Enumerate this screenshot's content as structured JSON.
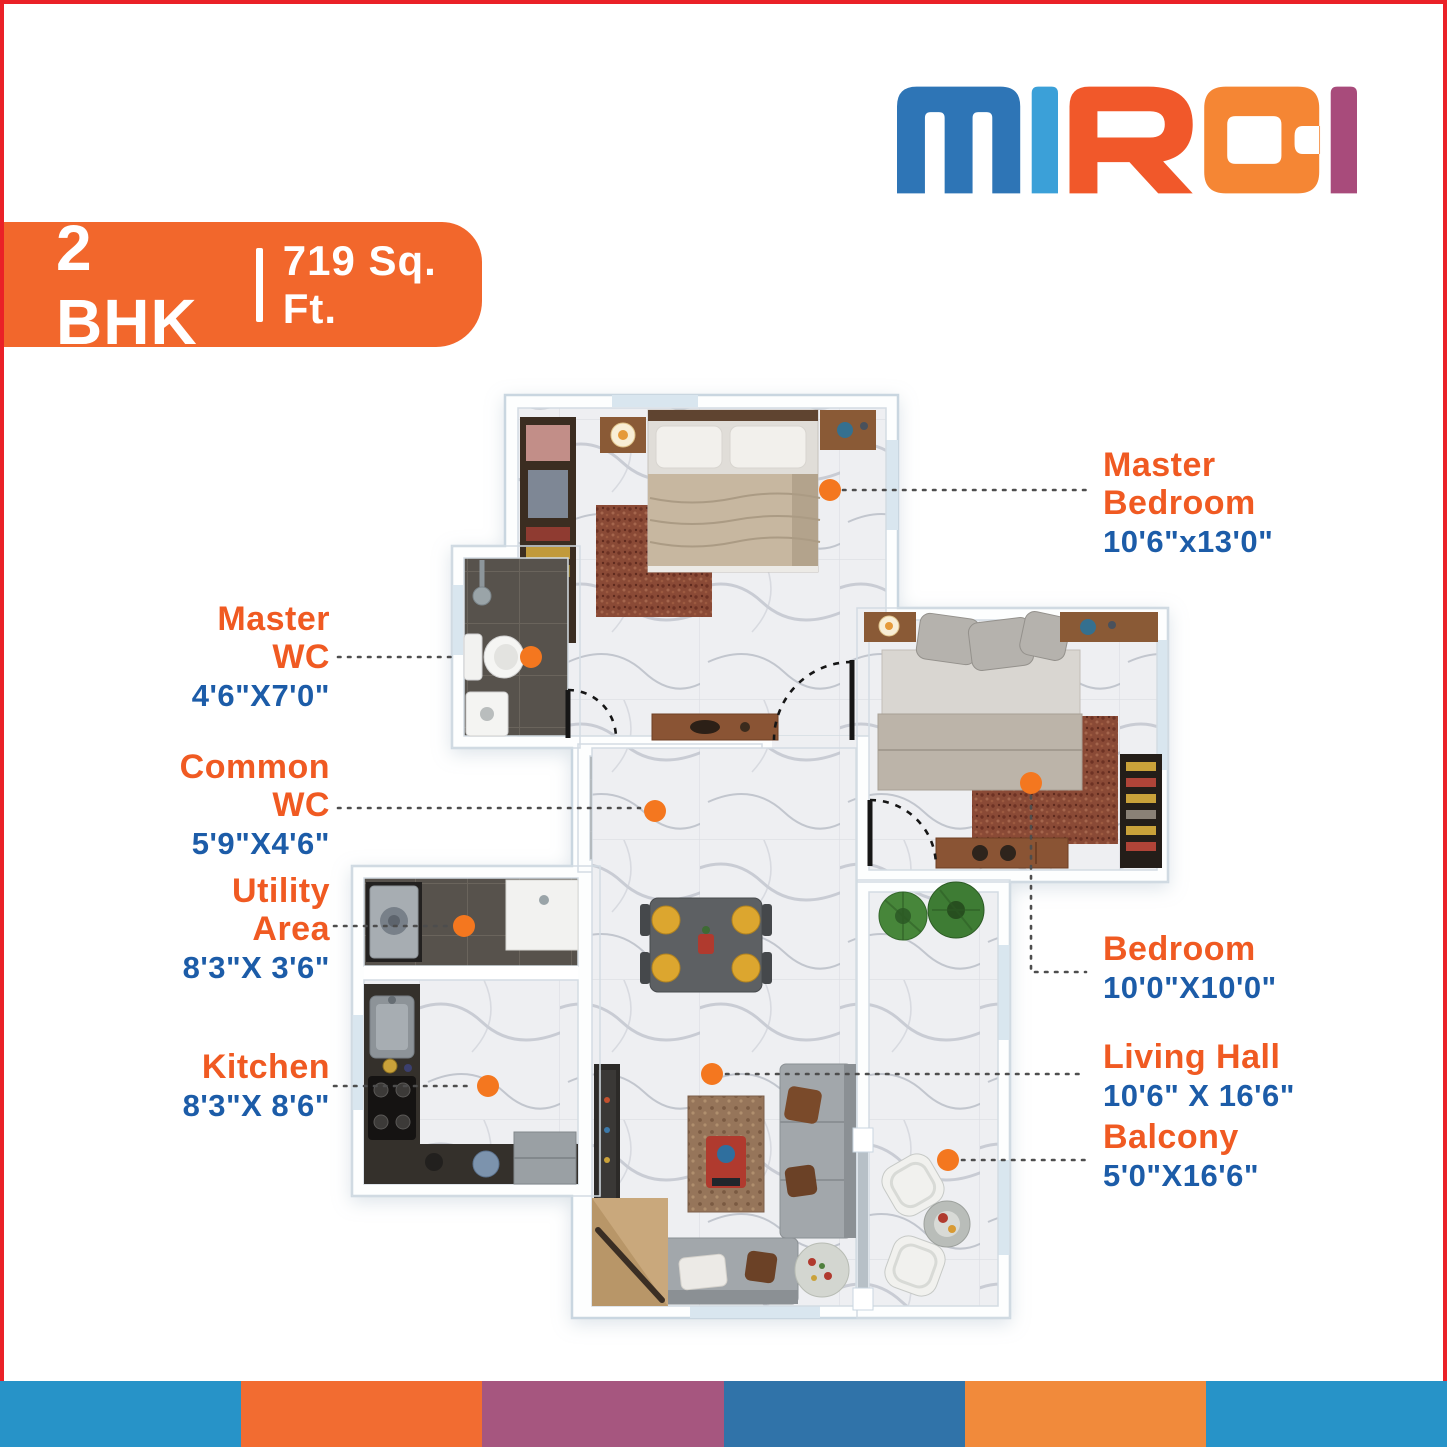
{
  "brand": {
    "name": "MIRAI",
    "letters": [
      {
        "char": "m",
        "color": "#2e75b6"
      },
      {
        "char": "i",
        "color": "#3ba0d8"
      },
      {
        "char": "R",
        "color": "#f1582a"
      },
      {
        "char": "a",
        "color": "#f58634"
      },
      {
        "char": "i",
        "color": "#a84b7b"
      }
    ]
  },
  "banner": {
    "unit_type": "2 BHK",
    "separator": "|",
    "area": "719 Sq. Ft."
  },
  "rooms": [
    {
      "id": "master-bedroom",
      "side": "right",
      "name_lines": [
        "Master",
        "Bedroom"
      ],
      "dimensions": "10'6\"x13'0\""
    },
    {
      "id": "master-wc",
      "side": "left",
      "name_lines": [
        "Master",
        "WC"
      ],
      "dimensions": "4'6\"X7'0\""
    },
    {
      "id": "common-wc",
      "side": "left",
      "name_lines": [
        "Common",
        "WC"
      ],
      "dimensions": "5'9\"X4'6\""
    },
    {
      "id": "utility-area",
      "side": "left",
      "name_lines": [
        "Utility",
        "Area"
      ],
      "dimensions": "8'3\"X 3'6\""
    },
    {
      "id": "kitchen",
      "side": "left",
      "name_lines": [
        "Kitchen"
      ],
      "dimensions": "8'3\"X 8'6\""
    },
    {
      "id": "bedroom",
      "side": "right",
      "name_lines": [
        "Bedroom"
      ],
      "dimensions": "10'0\"X10'0\""
    },
    {
      "id": "living-hall",
      "side": "right",
      "name_lines": [
        "Living Hall"
      ],
      "dimensions": "10'6\" X 16'6\""
    },
    {
      "id": "balcony",
      "side": "right",
      "name_lines": [
        "Balcony"
      ],
      "dimensions": "5'0\"X16'6\""
    }
  ],
  "colors": {
    "accent-orange": "#f05a22",
    "dim-blue": "#1c5ca8",
    "banner-bg": "#f2672c",
    "banner-text": "#ffffff",
    "marker": "#f4771f",
    "border-red": "#ea2127",
    "leader-gray": "#4d4d4d"
  },
  "footer_strip": [
    "#2793c8",
    "#f26c31",
    "#a6567f",
    "#3073a9",
    "#f18a3b",
    "#2793c8"
  ]
}
